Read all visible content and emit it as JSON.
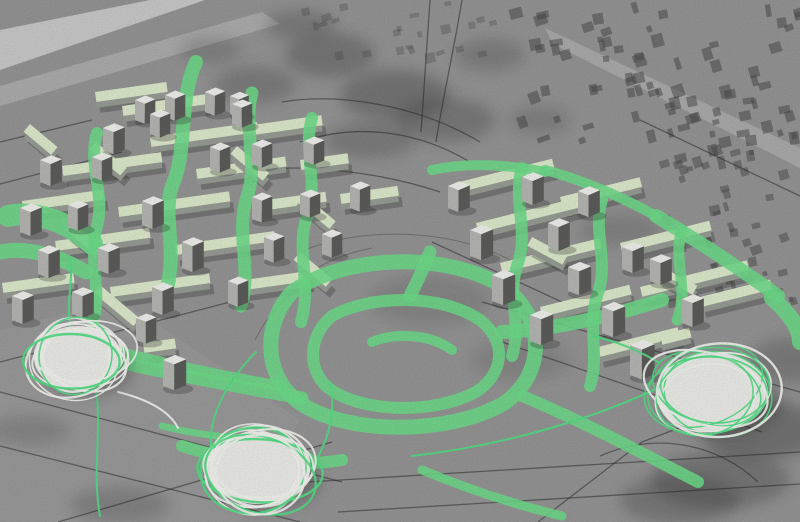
{
  "scene": {
    "description": "photograph-of-physical-urban-design-model-on-grayscale-map",
    "canvas": {
      "width": 800,
      "height": 522
    },
    "colors": {
      "base": "#989898",
      "band_light1": "#d6d6d6",
      "band_light2": "#c7c7c7",
      "band_road": "#bcbcbc",
      "patch_dark": "#353535",
      "city_block": "#474747",
      "map_line": "#262626",
      "slab_side": "#9aa098",
      "slab_top": "#e1eecf",
      "tower_top": "#f4f4f1",
      "tower_left": "#b9b9b6",
      "tower_right": "#5e5e5c",
      "shadow": "#2f2f2f",
      "paint_green": "#70e08c",
      "wire_green": "#55e287",
      "wire_white": "#f7f7f4",
      "disc_fill": "#f0f0ec"
    },
    "light_bands": [
      {
        "pts": "0,30 150,0 205,0 0,70",
        "fill": "#d6d6d6",
        "op": 0.85
      },
      {
        "pts": "0,86 262,12 280,24 0,106",
        "fill": "#c7c7c7",
        "op": 0.5
      },
      {
        "pts": "545,28 800,148 800,168 553,44",
        "fill": "#bcbcbc",
        "op": 0.6
      },
      {
        "pts": "0,330 120,300 300,420 240,522 0,522",
        "fill": "#a8a8a8",
        "op": 0.3
      }
    ],
    "dark_patches": [
      [
        330,
        55,
        45,
        22,
        0.3
      ],
      [
        395,
        95,
        55,
        25,
        0.32
      ],
      [
        300,
        25,
        35,
        15,
        0.25
      ],
      [
        445,
        120,
        50,
        22,
        0.28
      ],
      [
        255,
        85,
        40,
        18,
        0.25
      ],
      [
        490,
        55,
        35,
        16,
        0.22
      ],
      [
        370,
        140,
        45,
        18,
        0.25
      ],
      [
        540,
        120,
        30,
        14,
        0.2
      ],
      [
        210,
        50,
        30,
        14,
        0.2
      ],
      [
        760,
        430,
        60,
        30,
        0.35
      ],
      [
        720,
        480,
        70,
        28,
        0.3
      ],
      [
        790,
        360,
        40,
        22,
        0.25
      ],
      [
        680,
        500,
        60,
        24,
        0.28
      ],
      [
        120,
        505,
        50,
        18,
        0.22
      ],
      [
        30,
        430,
        40,
        15,
        0.18
      ],
      [
        430,
        300,
        60,
        25,
        0.14
      ],
      [
        520,
        360,
        50,
        20,
        0.14
      ],
      [
        620,
        230,
        40,
        16,
        0.18
      ]
    ],
    "city_regions": [
      {
        "x": 505,
        "y": 0,
        "w": 295,
        "h": 158,
        "count": 85,
        "min": 5,
        "max": 13,
        "seed": 7,
        "op": 0.5
      },
      {
        "x": 655,
        "y": 150,
        "w": 145,
        "h": 150,
        "count": 45,
        "min": 4,
        "max": 11,
        "seed": 11,
        "op": 0.45
      },
      {
        "x": 300,
        "y": 0,
        "w": 200,
        "h": 55,
        "count": 24,
        "min": 4,
        "max": 10,
        "seed": 3,
        "op": 0.3
      }
    ],
    "map_lines": [
      {
        "d": "M0,392 L342,482"
      },
      {
        "d": "M0,446 L300,522"
      },
      {
        "d": "M58,522 L332,442"
      },
      {
        "d": "M0,362 L230,302"
      },
      {
        "d": "M308,482 L800,452"
      },
      {
        "d": "M338,512 L800,484"
      },
      {
        "d": "M538,522 L642,442 L700,420"
      },
      {
        "d": "M600,456 C660,430 720,446 758,482"
      },
      {
        "d": "M300,142 C360,122 420,132 470,162"
      },
      {
        "d": "M282,102 C340,92 420,106 480,142"
      },
      {
        "d": "M430,0 L421,132"
      },
      {
        "d": "M462,0 C452,60 442,102 436,142"
      },
      {
        "d": "M232,172 C300,162 380,172 440,192"
      },
      {
        "d": "M482,302 L800,392"
      },
      {
        "d": "M502,342 L762,432"
      },
      {
        "d": "M432,242 L562,302"
      },
      {
        "d": "M0,142 L92,120"
      },
      {
        "d": "M0,184 L122,152"
      },
      {
        "d": "M640,120 L800,196"
      }
    ],
    "contours": [
      {
        "d": "M300,252 C360,226 450,228 510,260"
      },
      {
        "d": "M282,302 C302,272 332,256 372,248"
      },
      {
        "d": "M255,340 C270,310 295,285 330,270"
      }
    ],
    "slabs": [
      [
        95,
        98,
        72,
        -8
      ],
      [
        122,
        112,
        95,
        -8
      ],
      [
        150,
        143,
        108,
        -8
      ],
      [
        252,
        131,
        70,
        -8
      ],
      [
        62,
        172,
        100,
        -8
      ],
      [
        196,
        175,
        90,
        -8
      ],
      [
        22,
        207,
        82,
        -8
      ],
      [
        118,
        213,
        112,
        -8
      ],
      [
        252,
        208,
        74,
        -8
      ],
      [
        55,
        247,
        95,
        -8
      ],
      [
        175,
        251,
        100,
        -8
      ],
      [
        2,
        289,
        72,
        -8
      ],
      [
        110,
        293,
        100,
        -8
      ],
      [
        230,
        288,
        80,
        -8
      ],
      [
        340,
        200,
        58,
        -8
      ],
      [
        300,
        166,
        48,
        -8
      ],
      [
        143,
        349,
        32,
        -8
      ],
      [
        96,
        148,
        40,
        40
      ],
      [
        237,
        152,
        42,
        40
      ],
      [
        302,
        199,
        44,
        40
      ],
      [
        72,
        228,
        38,
        40
      ],
      [
        300,
        258,
        42,
        40
      ],
      [
        30,
        130,
        36,
        40
      ],
      [
        100,
        291,
        52,
        40
      ],
      [
        455,
        189,
        100,
        -14
      ],
      [
        560,
        203,
        82,
        -14
      ],
      [
        476,
        229,
        110,
        -14
      ],
      [
        620,
        249,
        92,
        -14
      ],
      [
        500,
        269,
        102,
        -14
      ],
      [
        640,
        293,
        110,
        -14
      ],
      [
        540,
        313,
        92,
        -14
      ],
      [
        598,
        353,
        82,
        -14
      ],
      [
        700,
        303,
        72,
        -14
      ],
      [
        660,
        341,
        30,
        -14
      ],
      [
        532,
        243,
        40,
        28
      ],
      [
        662,
        273,
        40,
        28
      ]
    ],
    "towers": [
      [
        135,
        100,
        14,
        20
      ],
      [
        165,
        95,
        14,
        22
      ],
      [
        205,
        92,
        14,
        20
      ],
      [
        230,
        96,
        13,
        18
      ],
      [
        103,
        128,
        15,
        22
      ],
      [
        150,
        114,
        14,
        20
      ],
      [
        232,
        104,
        14,
        20
      ],
      [
        40,
        160,
        15,
        22
      ],
      [
        92,
        157,
        14,
        20
      ],
      [
        210,
        147,
        14,
        22
      ],
      [
        252,
        144,
        14,
        20
      ],
      [
        304,
        141,
        14,
        20
      ],
      [
        20,
        208,
        15,
        24
      ],
      [
        68,
        205,
        14,
        22
      ],
      [
        142,
        201,
        15,
        24
      ],
      [
        252,
        197,
        14,
        22
      ],
      [
        300,
        194,
        14,
        20
      ],
      [
        38,
        250,
        15,
        24
      ],
      [
        98,
        248,
        15,
        22
      ],
      [
        182,
        242,
        15,
        26
      ],
      [
        264,
        237,
        14,
        22
      ],
      [
        322,
        234,
        14,
        20
      ],
      [
        12,
        296,
        15,
        24
      ],
      [
        72,
        292,
        15,
        22
      ],
      [
        152,
        287,
        15,
        24
      ],
      [
        228,
        281,
        14,
        22
      ],
      [
        136,
        318,
        14,
        22
      ],
      [
        163,
        360,
        16,
        26
      ],
      [
        350,
        186,
        14,
        22
      ],
      [
        448,
        186,
        15,
        22
      ],
      [
        522,
        177,
        15,
        24
      ],
      [
        578,
        191,
        15,
        22
      ],
      [
        470,
        230,
        16,
        26
      ],
      [
        548,
        223,
        15,
        24
      ],
      [
        622,
        247,
        15,
        22
      ],
      [
        492,
        275,
        16,
        26
      ],
      [
        568,
        267,
        16,
        24
      ],
      [
        650,
        259,
        15,
        22
      ],
      [
        530,
        315,
        16,
        26
      ],
      [
        602,
        307,
        16,
        26
      ],
      [
        682,
        299,
        15,
        24
      ],
      [
        630,
        345,
        17,
        30
      ]
    ],
    "streaks": [
      {
        "d": "M196,62 C178,100 188,152 172,186 C162,216 178,250 166,292",
        "w": 14
      },
      {
        "d": "M97,133 C87,165 107,196 96,230 C89,260 102,292 93,322",
        "w": 12
      },
      {
        "d": "M252,93 C242,128 260,164 246,200 C236,236 252,270 241,306",
        "w": 13
      },
      {
        "d": "M312,118 C302,150 320,186 306,220 C296,250 312,286 301,322",
        "w": 12
      },
      {
        "d": "M8,216 C38,210 72,224 92,244",
        "w": 22
      },
      {
        "d": "M0,252 C30,246 62,258 86,272",
        "w": 15
      },
      {
        "d": "M60,336 C130,356 200,372 282,386",
        "w": 10
      },
      {
        "d": "M92,356 C162,372 232,386 302,398",
        "w": 13
      },
      {
        "d": "M522,168 C512,200 530,232 517,266 C507,296 522,326 512,356",
        "w": 12
      },
      {
        "d": "M602,200 C592,230 610,262 597,296 C587,326 600,356 590,386",
        "w": 12
      },
      {
        "d": "M682,230 C672,260 690,290 677,320",
        "w": 11
      },
      {
        "d": "M432,170 C470,162 510,165 545,172",
        "w": 10
      },
      {
        "d": "M545,170 C582,180 620,196 656,216",
        "w": 10
      },
      {
        "d": "M656,216 C700,242 742,270 778,296",
        "w": 14
      },
      {
        "d": "M772,298 C790,314 800,328 800,342",
        "w": 16
      },
      {
        "d": "M662,300 C606,318 548,330 502,332",
        "w": 14
      },
      {
        "d": "M430,252 C422,272 416,284 410,296",
        "w": 13
      },
      {
        "d": "M292,292 C342,256 442,250 502,286 C546,316 546,372 506,402 C450,436 342,436 296,400 C262,372 264,322 292,292",
        "w": 15
      },
      {
        "d": "M332,316 C372,294 442,294 480,320 C506,340 506,372 476,392 C430,416 356,412 326,386 C306,366 310,334 332,316",
        "w": 12
      },
      {
        "d": "M372,342 C396,332 430,334 452,350",
        "w": 10
      },
      {
        "d": "M182,446 C232,462 292,468 342,460",
        "w": 12
      },
      {
        "d": "M162,426 C202,436 242,440 282,438",
        "w": 7
      },
      {
        "d": "M522,396 C580,420 640,452 698,482",
        "w": 12
      },
      {
        "d": "M422,470 C470,490 520,506 562,516",
        "w": 9
      }
    ],
    "wires": [
      {
        "d": "M96,390 C102,430 92,472 100,516",
        "c": "g"
      },
      {
        "d": "M70,326 C66,300 74,278 70,258",
        "c": "g"
      },
      {
        "d": "M212,452 C206,420 226,382 256,352",
        "c": "g"
      },
      {
        "d": "M310,470 C330,440 336,410 330,382",
        "c": "g"
      },
      {
        "d": "M662,386 C592,420 500,446 412,456",
        "c": "g"
      },
      {
        "d": "M658,362 C634,348 612,340 592,336",
        "c": "g"
      },
      {
        "d": "M118,392 C150,400 170,412 178,428",
        "c": "w"
      }
    ],
    "discs": [
      {
        "cx": 78,
        "cy": 358,
        "rx": 44,
        "ry": 32,
        "seed": 5
      },
      {
        "cx": 258,
        "cy": 468,
        "rx": 52,
        "ry": 36,
        "seed": 9
      },
      {
        "cx": 712,
        "cy": 392,
        "rx": 56,
        "ry": 40,
        "seed": 13
      }
    ],
    "grain": {
      "freq": 0.85,
      "opacity": 0.16
    }
  }
}
